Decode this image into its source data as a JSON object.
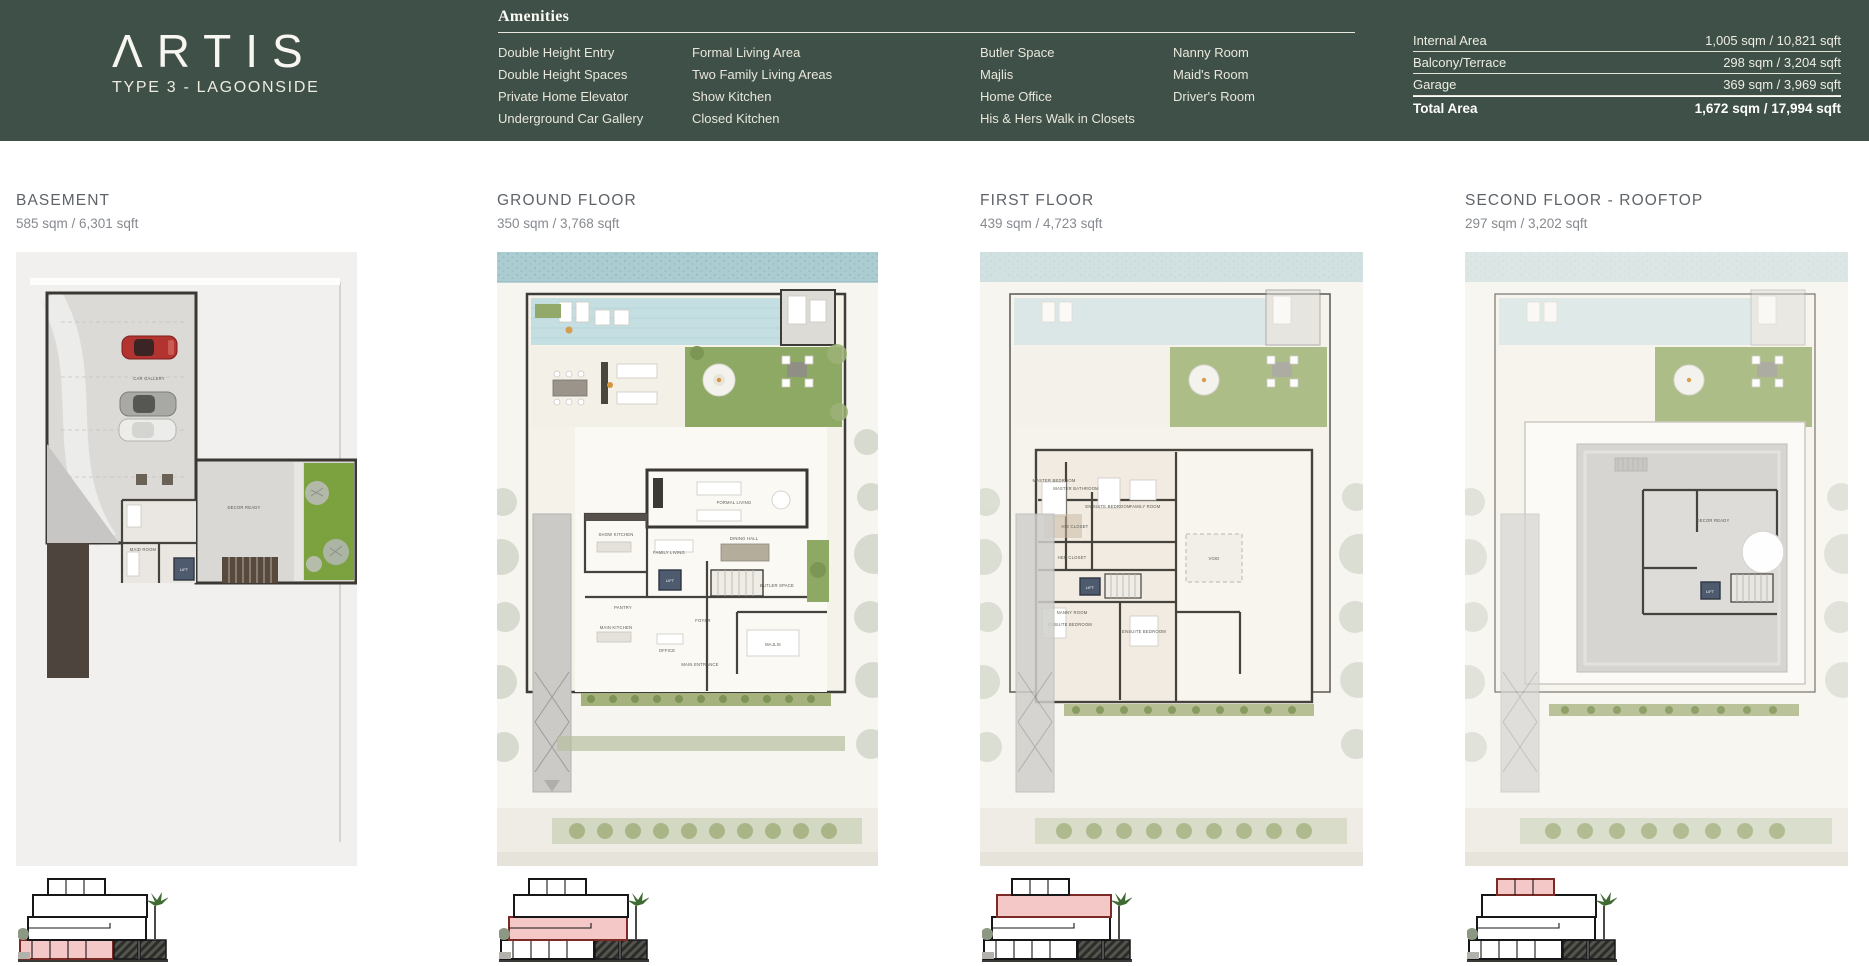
{
  "brand": {
    "logo_text": "ΛRTIS",
    "subtitle": "TYPE 3 - LAGOONSIDE"
  },
  "amenities": {
    "title": "Amenities",
    "columns": [
      [
        "Double Height Entry",
        "Double Height Spaces",
        "Private Home Elevator",
        "Underground Car Gallery"
      ],
      [
        "Formal Living Area",
        "Two Family Living Areas",
        "Show Kitchen",
        "Closed Kitchen"
      ],
      [
        "Butler Space",
        "Majlis",
        "Home Office",
        "His & Hers Walk in Closets"
      ],
      [
        "Nanny Room",
        "Maid's Room",
        "Driver's Room"
      ]
    ]
  },
  "area_table": {
    "rows": [
      {
        "label": "Internal Area",
        "value": "1,005 sqm / 10,821 sqft"
      },
      {
        "label": "Balcony/Terrace",
        "value": "298 sqm / 3,204 sqft"
      },
      {
        "label": "Garage",
        "value": "369 sqm / 3,969 sqft"
      }
    ],
    "total": {
      "label": "Total Area",
      "value": "1,672 sqm / 17,994 sqft"
    }
  },
  "floors": [
    {
      "title": "BASEMENT",
      "area": "585 sqm / 6,301 sqft",
      "rooms": [
        "CAR GALLERY",
        "DECOR READY",
        "MAID ROOM",
        "LIFT"
      ]
    },
    {
      "title": "GROUND FLOOR",
      "area": "350 sqm / 3,768 sqft",
      "rooms": [
        "FORMAL LIVING",
        "DINING HALL",
        "SHOW KITCHEN",
        "FAMILY LIVING",
        "BUTLER SPACE",
        "PANTRY",
        "MAIN KITCHEN",
        "OFFICE",
        "FOYER",
        "MAJLIS",
        "MAIN ENTRANCE",
        "LIFT"
      ]
    },
    {
      "title": "FIRST FLOOR",
      "area": "439 sqm / 4,723 sqft",
      "rooms": [
        "MASTER BEDROOM",
        "MASTER BATHROOM",
        "EN SUITE BEDROOM",
        "FAMILY ROOM",
        "HIS CLOSET",
        "HER CLOSET",
        "VOID",
        "NANNY ROOM",
        "ENSUITE BEDROOM",
        "ENSUITE BEDROOM",
        "LIFT"
      ]
    },
    {
      "title": "SECOND FLOOR - ROOFTOP",
      "area": "297 sqm / 3,202 sqft",
      "rooms": [
        "DECOR READY",
        "LIFT"
      ]
    }
  ],
  "colors": {
    "header_green": "#3E5047",
    "highlight_pink": "#F3C8C7",
    "water": "#ABCCD1",
    "pool": "#C4DEE2",
    "lawn": "#8EA963",
    "car_red": "#B23330"
  }
}
